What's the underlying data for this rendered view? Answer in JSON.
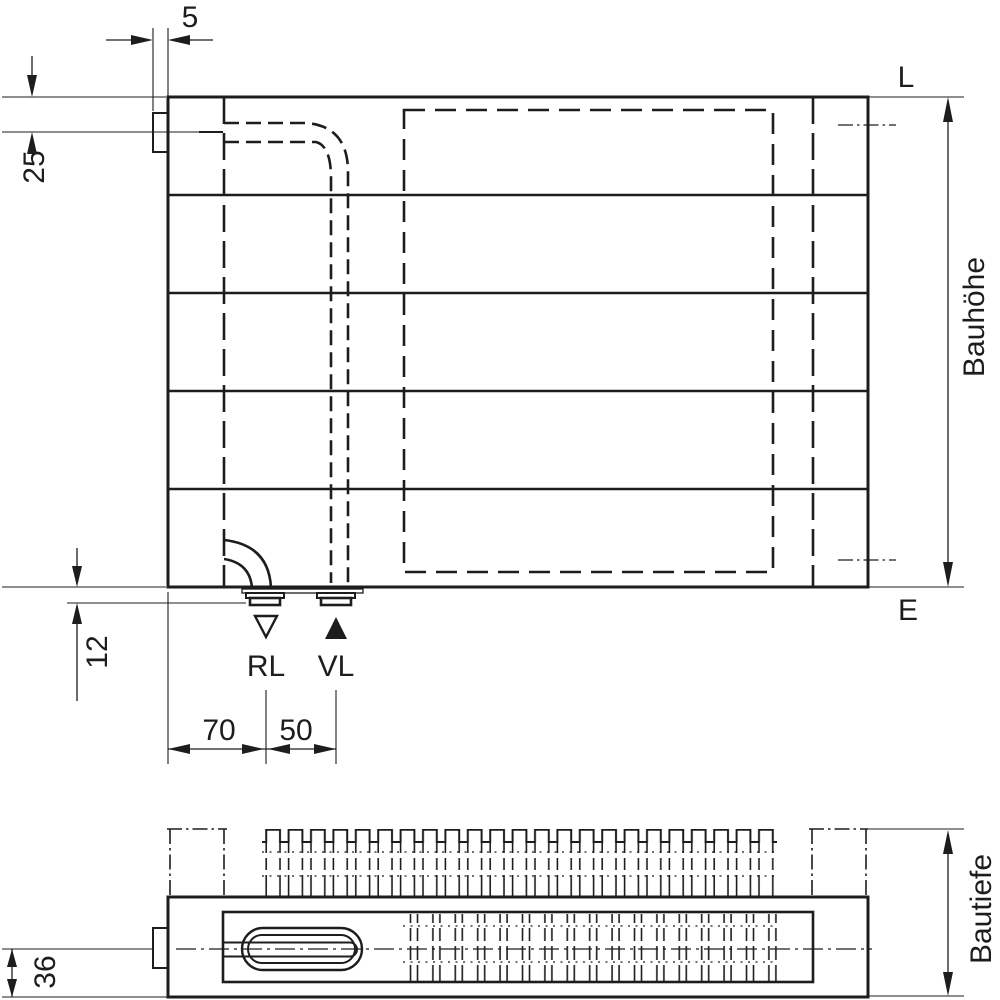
{
  "colors": {
    "line": "#1d1d1b",
    "background": "#ffffff"
  },
  "front_view": {
    "dims": {
      "bracket_width": "5",
      "top_edge_to_pipe_center": "25",
      "bottom_edge_to_connector": "12",
      "left_edge_to_rl": "70",
      "rl_to_vl": "50",
      "height_label": "Bauhöhe"
    },
    "labels": {
      "top_reference": "L",
      "bottom_reference": "E",
      "return_connection": "RL",
      "supply_connection": "VL"
    }
  },
  "top_view": {
    "dims": {
      "center_to_front": "36",
      "depth_label": "Bautiefe"
    }
  }
}
